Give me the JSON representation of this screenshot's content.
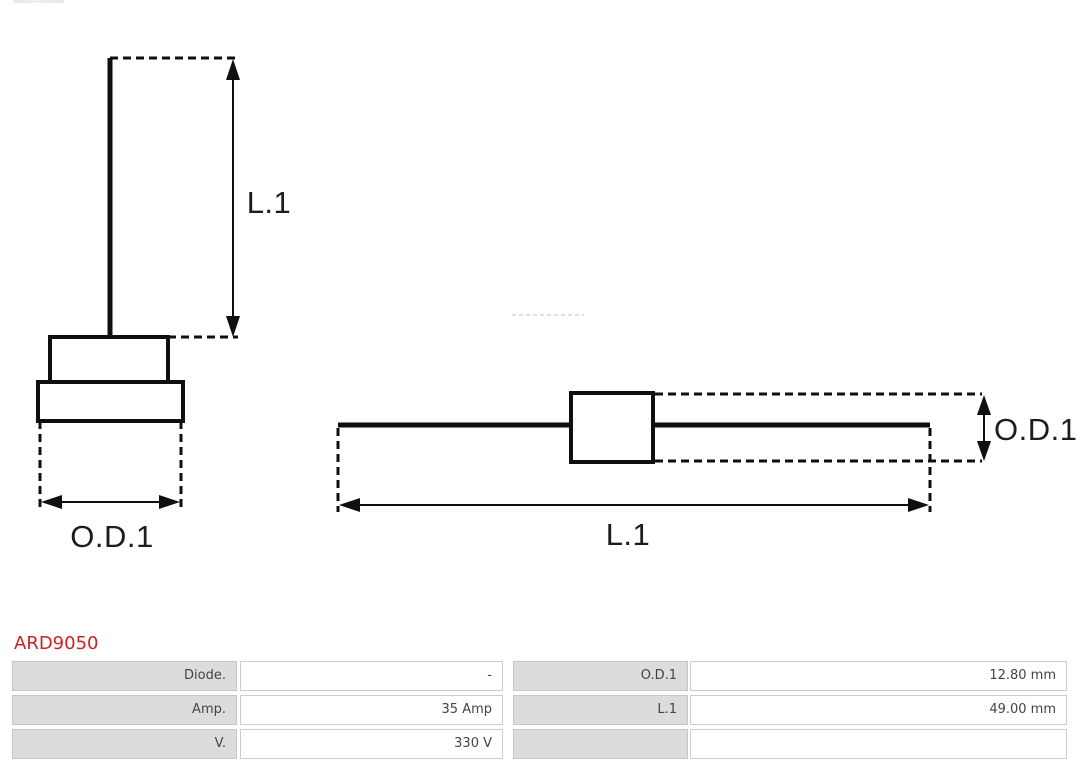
{
  "product": {
    "code": "ARD9050"
  },
  "diagrams": {
    "front_view": {
      "length_label": "L.1",
      "diameter_label": "O.D.1"
    },
    "side_view": {
      "length_label": "L.1",
      "diameter_label": "O.D.1"
    }
  },
  "spec_table": {
    "rows": [
      {
        "label_left": "Diode.",
        "value_left": "-",
        "label_right": "O.D.1",
        "value_right": "12.80 mm"
      },
      {
        "label_left": "Amp.",
        "value_left": "35 Amp",
        "label_right": "L.1",
        "value_right": "49.00 mm"
      },
      {
        "label_left": "V.",
        "value_left": "330 V",
        "label_right": "",
        "value_right": ""
      }
    ]
  },
  "colors": {
    "accent_red": "#cc2222",
    "cell_gray": "#dcdcdc",
    "line_black": "#0f0f0f"
  }
}
